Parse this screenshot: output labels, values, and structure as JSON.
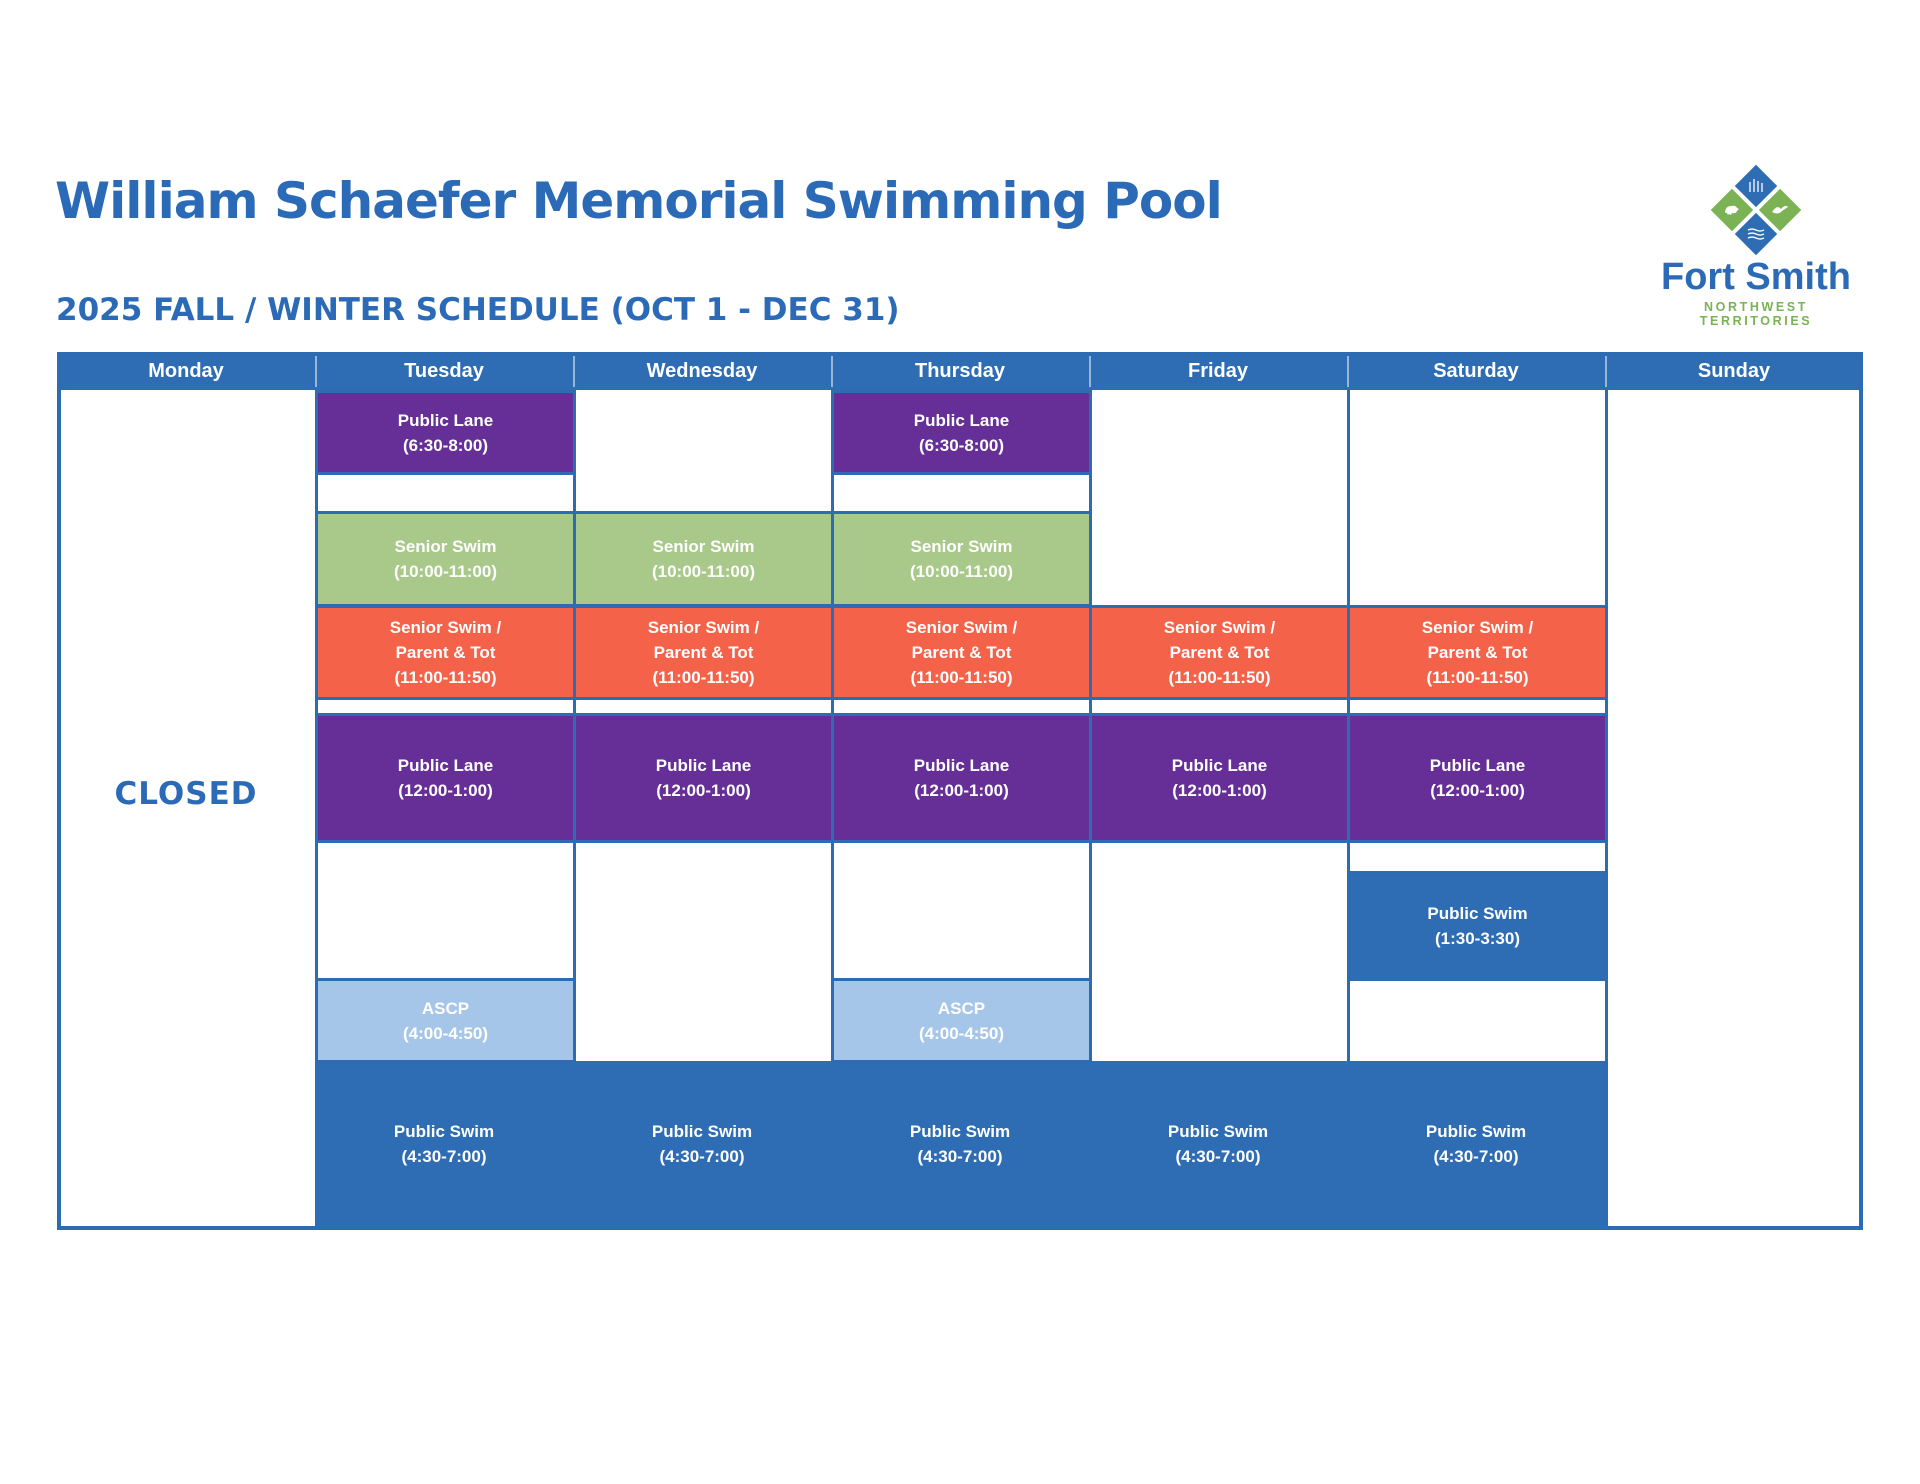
{
  "header": {
    "title": "William Schaefer Memorial Swimming Pool",
    "subtitle": "2025 FALL / WINTER SCHEDULE (OCT 1 - DEC 31)"
  },
  "logo": {
    "name": "Fort Smith",
    "tagline": "NORTHWEST TERRITORIES"
  },
  "colors": {
    "table_blue": "#2e6cb4",
    "purple": "#662f97",
    "green": "#a8c98a",
    "orange": "#f5624a",
    "light_blue": "#a6c6e9",
    "title_blue": "#2b6ab6",
    "logo_green": "#7ab254"
  },
  "events": {
    "early_lane": {
      "label": "Public Lane",
      "time": "(6:30-8:00)"
    },
    "senior_swim": {
      "label": "Senior Swim",
      "time": "(10:00-11:00)"
    },
    "senior_parent_tot": {
      "label": "Senior Swim /",
      "label2": "Parent & Tot",
      "time": "(11:00-11:50)"
    },
    "noon_lane": {
      "label": "Public Lane",
      "time": "(12:00-1:00)"
    },
    "saturday_swim": {
      "label": "Public Swim",
      "time": "(1:30-3:30)"
    },
    "ascp": {
      "label": "ASCP",
      "time": "(4:00-4:50)"
    },
    "evening_swim": {
      "label": "Public Swim",
      "time": "(4:30-7:00)"
    }
  },
  "schedule": {
    "days": [
      "Monday",
      "Tuesday",
      "Wednesday",
      "Thursday",
      "Friday",
      "Saturday",
      "Sunday"
    ],
    "closed_label": "CLOSED",
    "by_day": {
      "Monday": [
        "CLOSED"
      ],
      "Tuesday": [
        "Public Lane (6:30-8:00)",
        "Senior Swim (10:00-11:00)",
        "Senior Swim / Parent & Tot (11:00-11:50)",
        "Public Lane (12:00-1:00)",
        "ASCP (4:00-4:50)",
        "Public Swim (4:30-7:00)"
      ],
      "Wednesday": [
        "Senior Swim (10:00-11:00)",
        "Senior Swim / Parent & Tot (11:00-11:50)",
        "Public Lane (12:00-1:00)",
        "Public Swim (4:30-7:00)"
      ],
      "Thursday": [
        "Public Lane (6:30-8:00)",
        "Senior Swim (10:00-11:00)",
        "Senior Swim / Parent & Tot (11:00-11:50)",
        "Public Lane (12:00-1:00)",
        "ASCP (4:00-4:50)",
        "Public Swim (4:30-7:00)"
      ],
      "Friday": [
        "Senior Swim / Parent & Tot (11:00-11:50)",
        "Public Lane (12:00-1:00)",
        "Public Swim (4:30-7:00)"
      ],
      "Saturday": [
        "Senior Swim / Parent & Tot (11:00-11:50)",
        "Public Lane (12:00-1:00)",
        "Public Swim (1:30-3:30)",
        "Public Swim (4:30-7:00)"
      ],
      "Sunday": []
    }
  }
}
